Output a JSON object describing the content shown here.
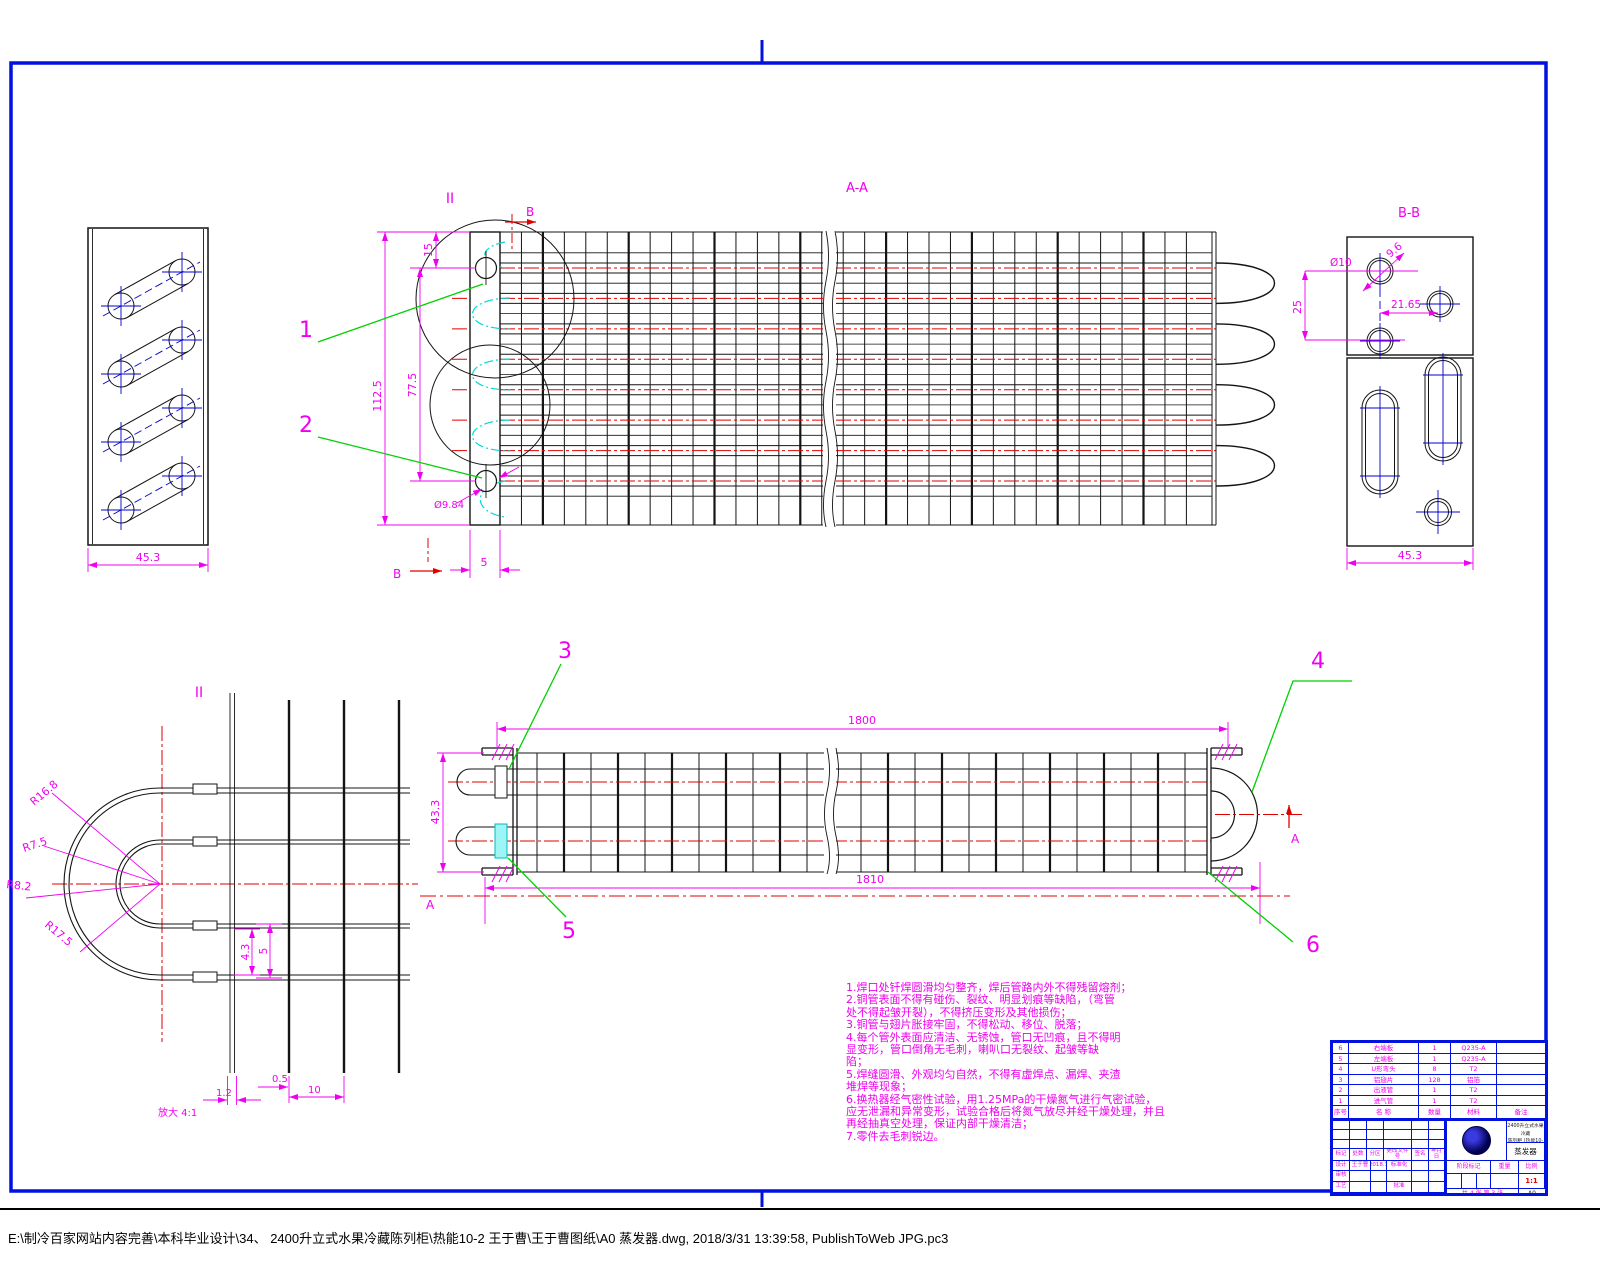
{
  "sheet": {
    "statusbar_path": "E:\\制冷百家网站内容完善\\本科毕业设计\\34、 2400升立式水果冷藏陈列柜\\热能10-2 王于曹\\王于曹图纸\\A0 蒸发器.dwg, 2018/3/31 13:39:58, PublishToWeb JPG.pc3"
  },
  "labels": {
    "section_aa": "A-A",
    "section_bb": "B-B",
    "detail_ii_marker": "II",
    "detail_ii_view": "II",
    "b_top": "B",
    "b_bottom": "B",
    "a_left": "A",
    "a_right": "A",
    "detail_scale": "放大 4:1"
  },
  "callouts": {
    "c1": "1",
    "c2": "2",
    "c3": "3",
    "c4": "4",
    "c5": "5",
    "c6": "6"
  },
  "dims": {
    "left_plate_width": "45.3",
    "main_height": "112.5",
    "main_span": "77.5",
    "main_offset": "15",
    "plate_thk": "5",
    "tube_dia": "Ø9.84",
    "bb_hole": "Ø10",
    "bb_pitch": "25",
    "bb_diag": "9.6",
    "bb_offset": "21.65",
    "bb_width": "45.3",
    "len_top": "1800",
    "len_bot": "1810",
    "side_h": "43.3",
    "det_a": "4.3",
    "det_b": "5",
    "det_c": "0.5",
    "det_d": "10",
    "det_e": "1.2",
    "r1": "R16.8",
    "r2": "R7.5",
    "r3": "R8.2",
    "r4": "R17.5"
  },
  "notes": {
    "lines": [
      "1.焊口处钎焊圆滑均匀整齐，焊后管路内外不得残留熔剂；",
      "2.铜管表面不得有碰伤、裂纹、明显划痕等缺陷，（弯管",
      "处不得起皱开裂），不得挤压变形及其他损伤；",
      "3.铜管与翅片胀接牢固，不得松动、移位、脱落；",
      "4.每个管外表面应清洁、无锈蚀，管口无凹痕，且不得明",
      "显变形，管口倒角无毛刺，喇叭口无裂纹、起皱等缺",
      "陷；",
      "5.焊缝圆滑、外观均匀自然，不得有虚焊点、漏焊、夹渣",
      "堆焊等现象；",
      "6.换热器经气密性试验，用1.25MPa的干燥氮气进行气密试验，",
      "应无泄漏和异常变形，试验合格后将氮气放尽并经干燥处理，并且",
      "再经抽真空处理，保证内部干燥清洁；",
      "7.零件去毛刺锐边。"
    ]
  },
  "title_block": {
    "bom": {
      "header": [
        "序号",
        "名 称",
        "数量",
        "材料",
        "备注"
      ],
      "rows": [
        [
          "6",
          "右端板",
          "1",
          "Q235-A",
          ""
        ],
        [
          "5",
          "左端板",
          "1",
          "Q235-A",
          ""
        ],
        [
          "4",
          "U形弯头",
          "8",
          "T2",
          ""
        ],
        [
          "3",
          "铝翅片",
          "128",
          "铝箔",
          ""
        ],
        [
          "2",
          "出液管",
          "1",
          "T2",
          ""
        ],
        [
          "1",
          "进气管",
          "1",
          "T2",
          ""
        ]
      ]
    },
    "fields": {
      "biaoji": "标记",
      "chushu": "处数",
      "fenqu": "分区",
      "genggai": "更改文件号",
      "qianming": "签名",
      "nianyueri": "年月日",
      "sheji": "设计",
      "sheji_name": "王于曹",
      "sheji_date": "2018.3",
      "biaozhunhua": "标准化",
      "shenhe": "审核",
      "gongyi": "工艺",
      "pizhun": "批准",
      "jieduan": "阶段标记",
      "zhongliang": "重量",
      "bili": "比例",
      "bili_val": "1:1",
      "sheets": "共 4 张 第 3 张",
      "org_line1": "2400升立式水果冷藏",
      "org_line2": "陈列柜 (热能10-2)",
      "part_name": "蒸发器",
      "size_label": "A0"
    }
  }
}
